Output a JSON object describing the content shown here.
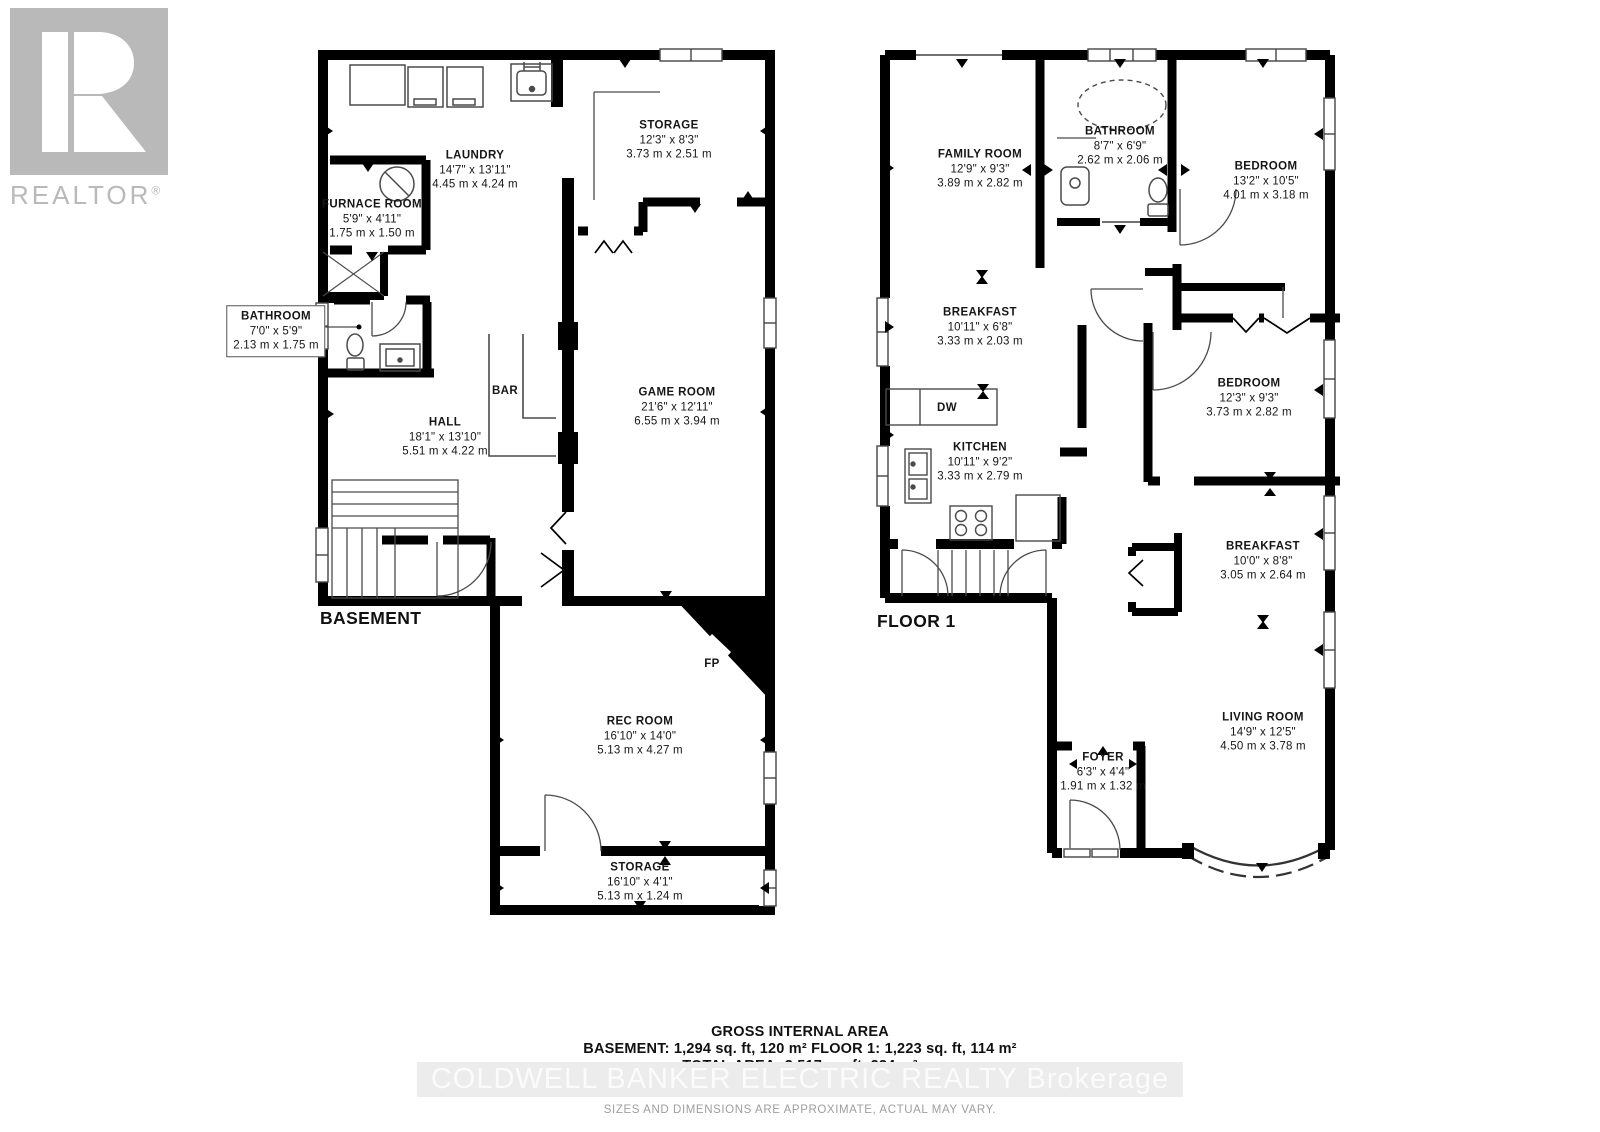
{
  "brand": {
    "name": "REALTOR",
    "reg": "®"
  },
  "floors": [
    {
      "label": "BASEMENT",
      "rooms": [
        {
          "name": "LAUNDRY",
          "imperial": "14'7\" x 13'11\"",
          "metric": "4.45 m x 4.24 m"
        },
        {
          "name": "STORAGE",
          "imperial": "12'3\" x 8'3\"",
          "metric": "3.73 m x 2.51 m"
        },
        {
          "name": "FURNACE ROOM",
          "imperial": "5'9\" x 4'11\"",
          "metric": "1.75 m x 1.50 m"
        },
        {
          "name": "BATHROOM",
          "imperial": "7'0\" x 5'9\"",
          "metric": "2.13 m x 1.75 m"
        },
        {
          "name": "HALL",
          "imperial": "18'1\" x 13'10\"",
          "metric": "5.51 m x 4.22 m"
        },
        {
          "name": "BAR"
        },
        {
          "name": "GAME ROOM",
          "imperial": "21'6\" x 12'11\"",
          "metric": "6.55 m x 3.94 m"
        },
        {
          "name": "FP"
        },
        {
          "name": "REC ROOM",
          "imperial": "16'10\" x 14'0\"",
          "metric": "5.13 m x 4.27 m"
        },
        {
          "name": "STORAGE",
          "imperial": "16'10\" x 4'1\"",
          "metric": "5.13 m x 1.24 m"
        }
      ]
    },
    {
      "label": "FLOOR 1",
      "rooms": [
        {
          "name": "FAMILY ROOM",
          "imperial": "12'9\" x 9'3\"",
          "metric": "3.89 m x 2.82 m"
        },
        {
          "name": "BATHROOM",
          "imperial": "8'7\" x 6'9\"",
          "metric": "2.62 m x 2.06 m"
        },
        {
          "name": "BEDROOM",
          "imperial": "13'2\" x 10'5\"",
          "metric": "4.01 m x 3.18 m"
        },
        {
          "name": "BREAKFAST",
          "imperial": "10'11\" x 6'8\"",
          "metric": "3.33 m x 2.03 m"
        },
        {
          "name": "DW"
        },
        {
          "name": "KITCHEN",
          "imperial": "10'11\" x 9'2\"",
          "metric": "3.33 m x 2.79 m"
        },
        {
          "name": "BEDROOM",
          "imperial": "12'3\" x 9'3\"",
          "metric": "3.73 m x 2.82 m"
        },
        {
          "name": "BREAKFAST",
          "imperial": "10'0\" x 8'8\"",
          "metric": "3.05 m x 2.64 m"
        },
        {
          "name": "LIVING ROOM",
          "imperial": "14'9\" x 12'5\"",
          "metric": "4.50 m x 3.78 m"
        },
        {
          "name": "FOYER",
          "imperial": "6'3\" x 4'4\"",
          "metric": "1.91 m x 1.32 m"
        }
      ]
    }
  ],
  "footer": {
    "area_title": "GROSS INTERNAL AREA",
    "area_line1": "BASEMENT: 1,294 sq. ft, 120 m² FLOOR 1: 1,223 sq. ft, 114 m²",
    "area_line2": "TOTAL AREA: 2,517 sq. ft, 234 m²",
    "watermark": "COLDWELL BANKER ELECTRIC REALTY  Brokerage",
    "disclaimer": "SIZES AND DIMENSIONS ARE APPROXIMATE, ACTUAL MAY VARY."
  },
  "colors": {
    "wall": "#000000",
    "fixture_line": "#4a4a4a",
    "logo_gray": "#b9b9b9",
    "watermark_bg": "#ececec",
    "watermark_text": "#fbfbfb"
  }
}
